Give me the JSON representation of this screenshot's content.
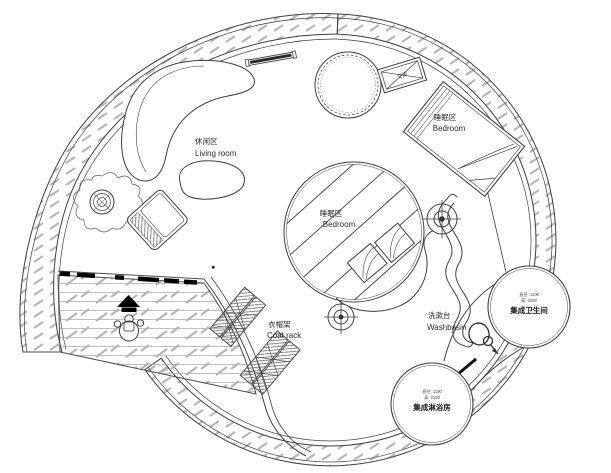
{
  "plan_type": "circular-house-floor-plan",
  "labels": {
    "living": {
      "zh": "休闲区",
      "en": "Living room"
    },
    "bedroom_main": {
      "zh": "睡眠区",
      "en": "Bedroom"
    },
    "bedroom_loft": {
      "zh": "睡眠区",
      "en": "Bedroom"
    },
    "coat_rack": {
      "zh": "衣帽架",
      "en": "Coat rack"
    },
    "washbasin": {
      "zh": "洗漱台",
      "en": "Washbasin"
    },
    "bathroom_pod": {
      "dia": "直径: 1100",
      "h": "高: 2100",
      "name": "集成卫生间"
    },
    "shower_pod": {
      "dia": "直径: 1100",
      "h": "高: 2100",
      "name": "集成淋浴房"
    },
    "ac_unit": {
      "zh": "空调"
    }
  },
  "colors": {
    "line": "#3f3f3f",
    "wall_hatch": "#b6b6b6",
    "floor_line": "#a9a9a9",
    "black": "#000000",
    "background": "#ffffff"
  }
}
